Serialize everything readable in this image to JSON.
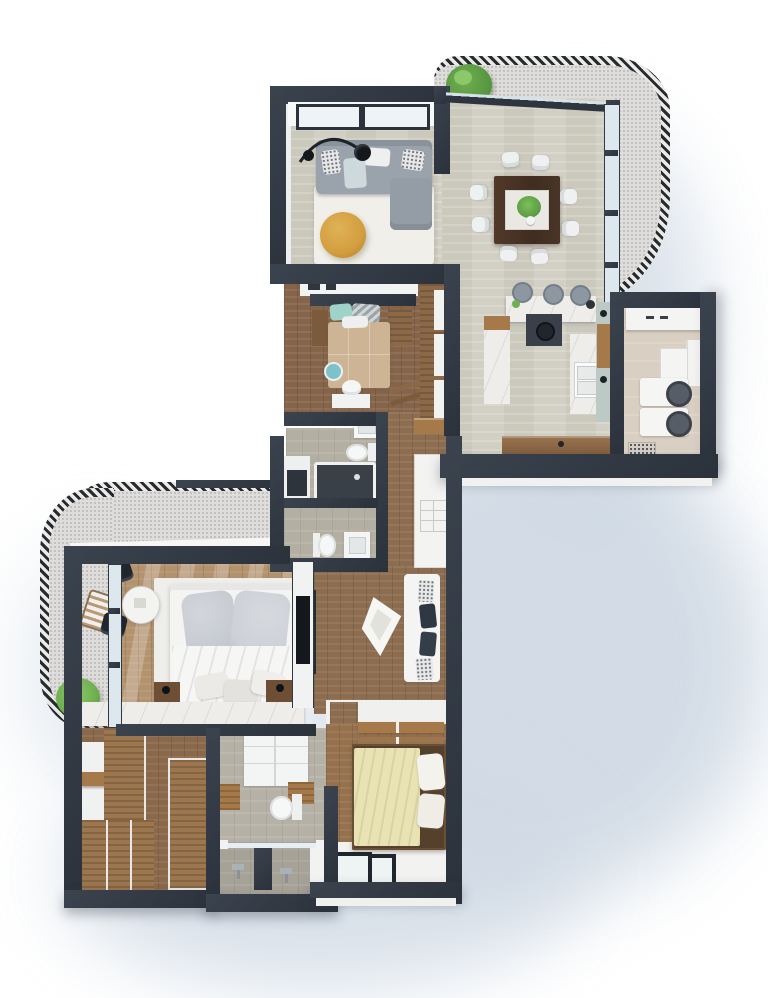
{
  "meta": {
    "type": "3d-floor-plan-render",
    "view": "top-down",
    "visible_text": "none"
  },
  "theme": {
    "colors": {
      "wall": "#3b434e",
      "wall-deep": "#2b323c",
      "white": "#f4f4f3",
      "trav": "#d2cfc4",
      "concrete": "#dedddb",
      "marble": "#efedea",
      "rail": "#262b31",
      "rail-light": "#eceae6",
      "glass": "#dce8ee",
      "bath-stone": "#b3afa2",
      "shadow": "#cfd9e4",
      "wood-mid": "#8f6f4f",
      "wood-dark": "#7c5a3c",
      "wood-light": "#b3926e",
      "wood-clay": "#a5794a",
      "beige": "#d9cfc2",
      "pale-wall": "#bcc9c5",
      "sofa": "#9aa2ab",
      "rug": "#f0efe9",
      "mustard": "#d29d3e",
      "teal": "#9fd2c9",
      "tan": "#cdb494",
      "cream": "#e9e3b4",
      "dark": "#20262e",
      "leaf": "#6faf4f",
      "leaf-dark": "#4c8a39"
    }
  },
  "scene": {
    "rooms": [
      {
        "name": "living-room",
        "floor": "travertine",
        "furniture": [
          "sectional-sofa",
          "chaise",
          "arc-floor-lamp",
          "area-rug",
          "round-pouf",
          "throw-pillows"
        ]
      },
      {
        "name": "dining-room",
        "floor": "travertine",
        "furniture": [
          "square-dining-table",
          "centerpiece-plant",
          "dining-chairs-x8"
        ]
      },
      {
        "name": "kitchen",
        "floor": "travertine",
        "furniture": [
          "marble-island",
          "bar-stools-x3",
          "cooktop",
          "double-sink",
          "u-counter",
          "wood-sideboard",
          "wall-shelf"
        ]
      },
      {
        "name": "laundry-room",
        "floor": "tile",
        "furniture": [
          "counter",
          "upper-cabinet",
          "washer",
          "dryer",
          "floor-drain"
        ]
      },
      {
        "name": "bedroom-1",
        "floor": "wood",
        "furniture": [
          "double-bed",
          "teal-pillow",
          "chevron-pillow",
          "side-benches",
          "desk",
          "desk-chair",
          "ladder-rack",
          "wardrobe-shelves",
          "round-rug"
        ]
      },
      {
        "name": "bathroom-1",
        "floor": "stone",
        "furniture": [
          "vanity-sink",
          "toilet",
          "bathtub",
          "appliance"
        ]
      },
      {
        "name": "bathroom-2",
        "floor": "stone",
        "furniture": [
          "toilet",
          "vanity-sink"
        ]
      },
      {
        "name": "hallway",
        "floor": "wood",
        "furniture": [
          "tall-cabinet",
          "wood-console",
          "tv-console",
          "origami-lounge-chair",
          "bench-with-pillows"
        ]
      },
      {
        "name": "master-bedroom",
        "floor": "wood",
        "furniture": [
          "king-bed",
          "gray-pillows",
          "nightstands",
          "table-lamps",
          "round-tea-table",
          "black-chairs-x2",
          "marble-credenza",
          "wall-tv",
          "area-rug"
        ]
      },
      {
        "name": "walk-in-closet",
        "floor": "wood",
        "furniture": [
          "wardrobe-units",
          "shelf-island",
          "open-shelves"
        ]
      },
      {
        "name": "master-bathroom",
        "floor": "tile",
        "furniture": [
          "vanity-drawers",
          "wood-bench",
          "toilet",
          "double-shower",
          "glass-partition",
          "shower-heads"
        ]
      },
      {
        "name": "bedroom-2",
        "floor": "wood",
        "furniture": [
          "double-bed",
          "cream-duvet",
          "white-pillows",
          "wall-shelf-unit",
          "low-window"
        ]
      },
      {
        "name": "balcony-upper",
        "floor": "concrete",
        "furniture": [
          "curved-railing",
          "tree-planter",
          "folding-chairs",
          "side-table"
        ]
      },
      {
        "name": "balcony-lower",
        "floor": "concrete",
        "furniture": [
          "curved-railing",
          "lounge-chair",
          "plant",
          "roof-beam"
        ]
      }
    ]
  }
}
